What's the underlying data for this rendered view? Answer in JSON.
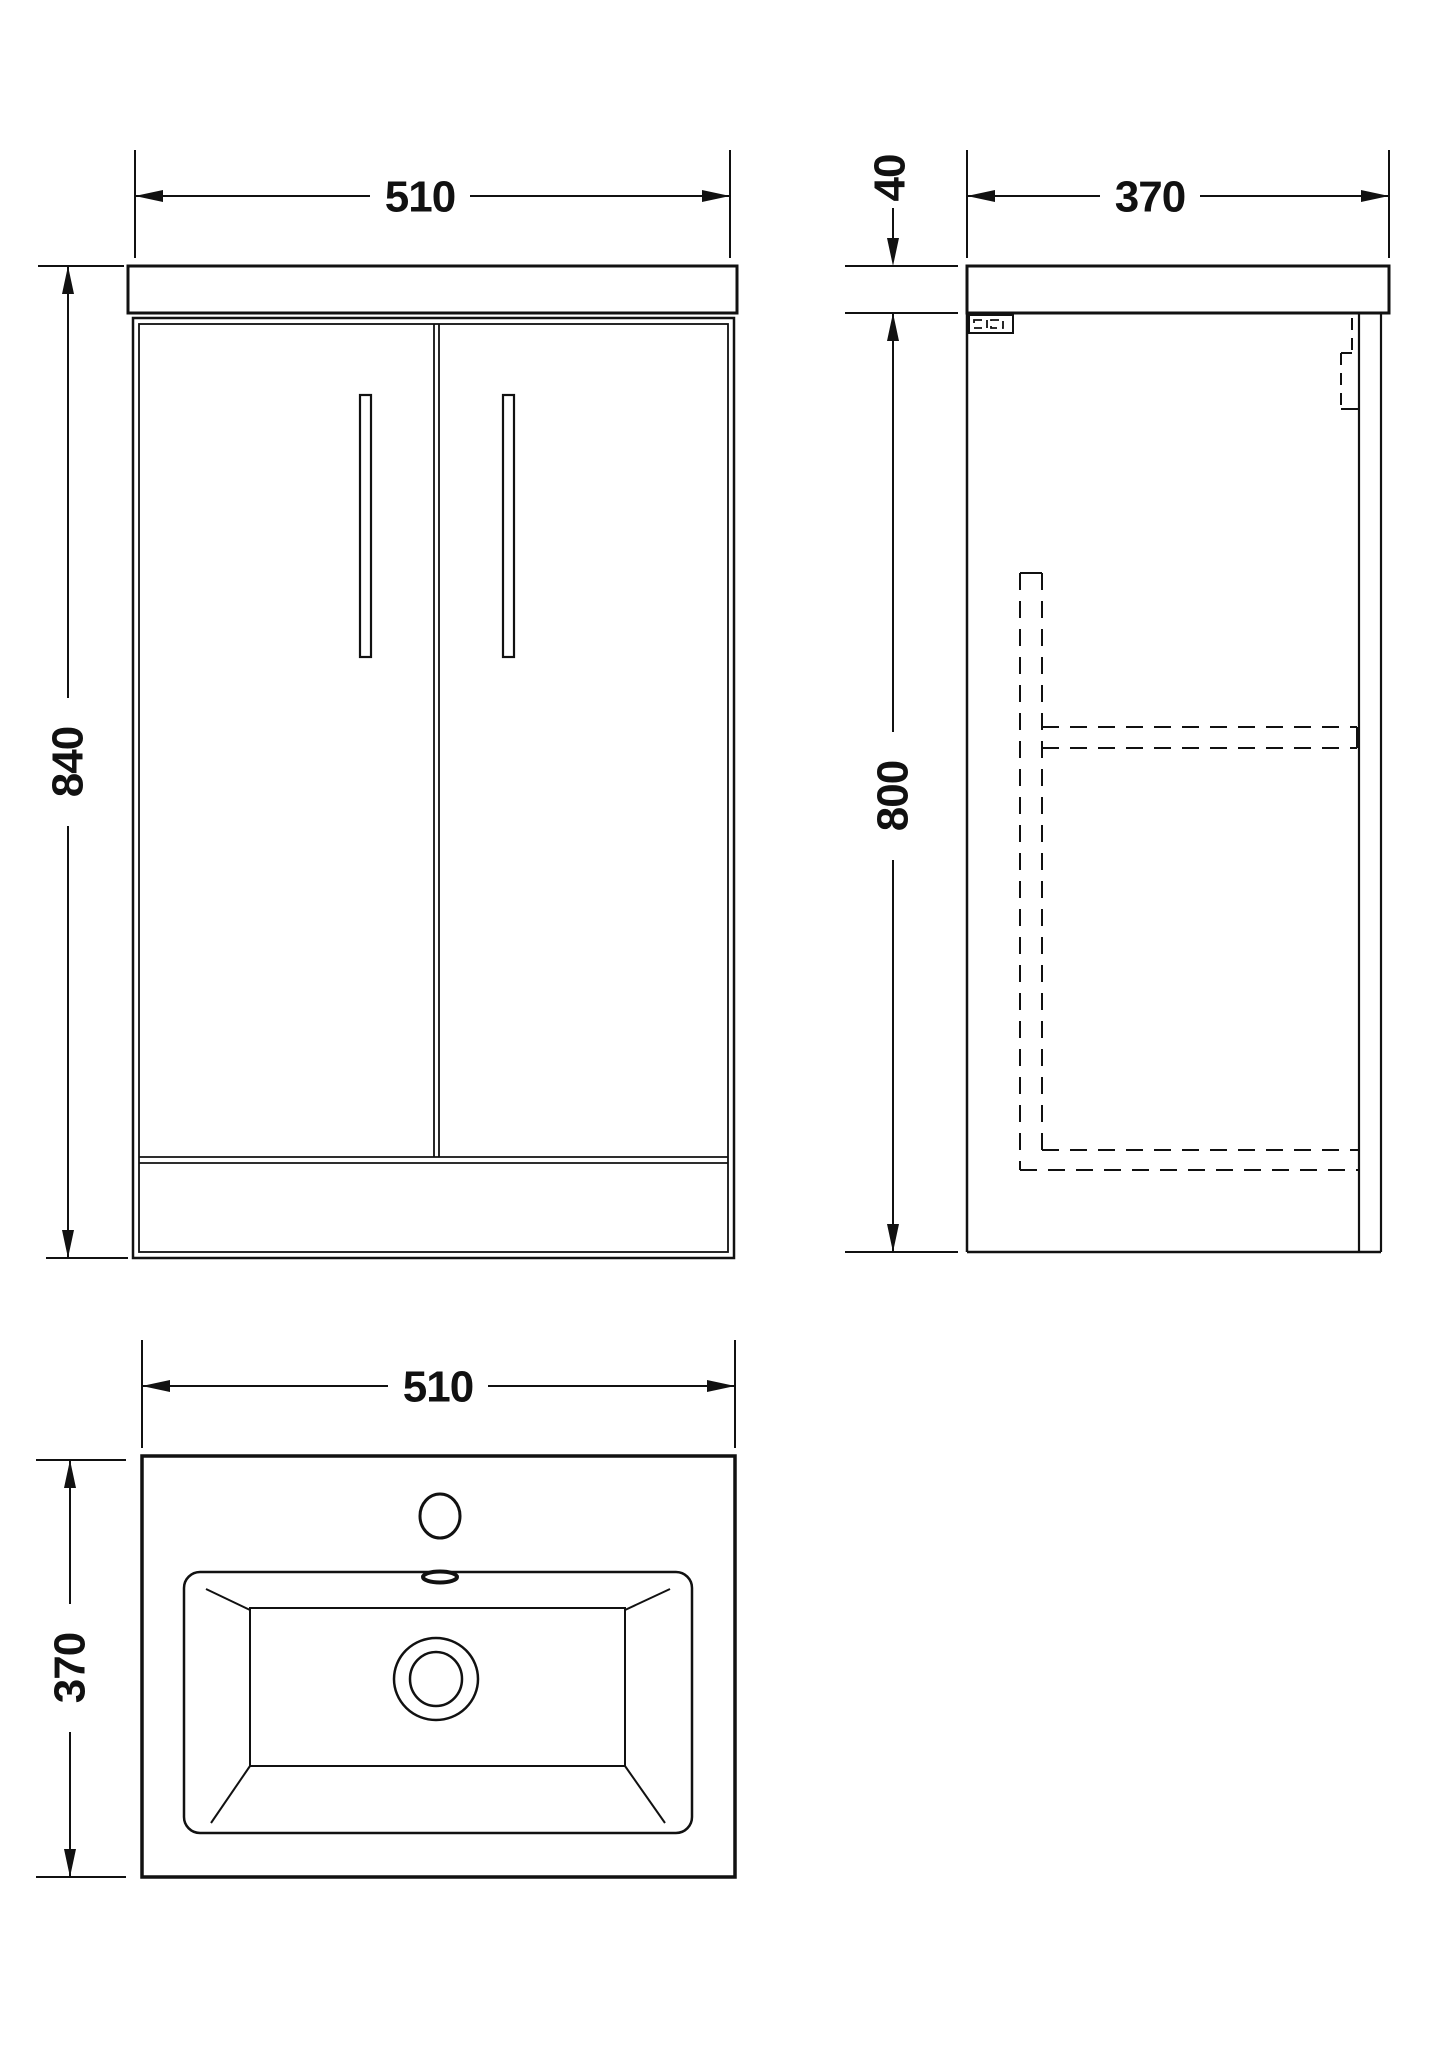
{
  "drawing": {
    "line_color": "#111111",
    "background_color": "#ffffff"
  },
  "dimensions": {
    "front": {
      "width": "510",
      "height": "840"
    },
    "side": {
      "depth": "370",
      "worktop_thickness": "40",
      "cabinet_height": "800"
    },
    "plan": {
      "width": "510",
      "depth": "370"
    }
  }
}
